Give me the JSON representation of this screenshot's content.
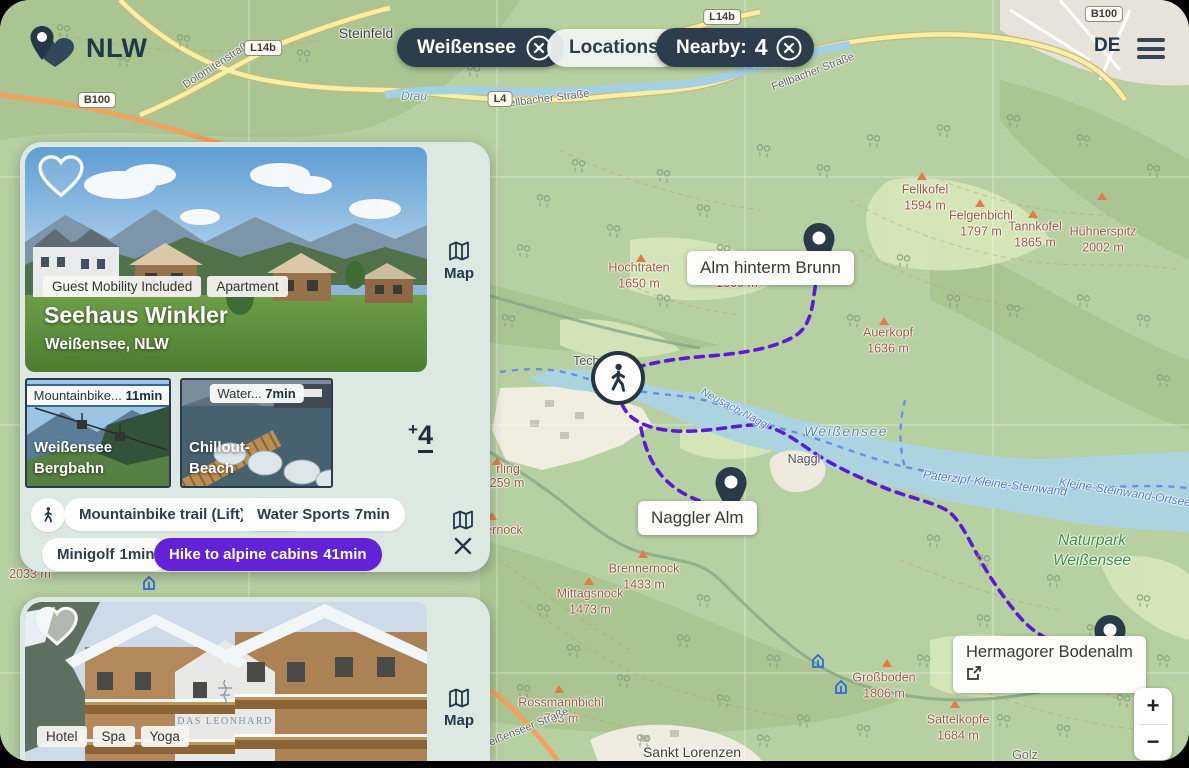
{
  "header": {
    "logo": "NLW",
    "filter_chip": "Weißensee",
    "locations": "Locations",
    "nearby_label": "Nearby:",
    "nearby_count": "4",
    "language": "DE"
  },
  "card1": {
    "tags": [
      "Guest Mobility Included",
      "Apartment"
    ],
    "title": "Seehaus Winkler",
    "subtitle": "Weißensee, NLW",
    "map_button": "Map",
    "thumbs": [
      {
        "label": "Mountainbike...",
        "time": "11min",
        "name1": "Weißensee",
        "name2": "Bergbahn"
      },
      {
        "label": "Water...",
        "time": "7min",
        "name1": "Chillout-",
        "name2": "Beach"
      }
    ],
    "more_plus": "+",
    "more_count": "4",
    "activities": [
      {
        "label": "Mountainbike trail (Lift)",
        "time": "11min"
      },
      {
        "label": "Water Sports",
        "time": "7min"
      },
      {
        "label": "Minigolf",
        "time": "1min"
      },
      {
        "label": "Hike to alpine cabins",
        "time": "41min"
      }
    ]
  },
  "card2": {
    "tags": [
      "Hotel",
      "Spa",
      "Yoga"
    ],
    "map_button": "Map",
    "building_sign": "DAS LEONHARD"
  },
  "map": {
    "pois": [
      {
        "label": "Alm hinterm Brunn"
      },
      {
        "label": "Naggler Alm"
      },
      {
        "label": "Hermagorer Bodenalm"
      }
    ],
    "zoom_in": "+",
    "zoom_out": "−",
    "towns": [
      "Steinfeld",
      "Fellbach",
      "Techendorf",
      "Naggl",
      "Sankt Lorenzen",
      "Golz"
    ],
    "peaks": [
      {
        "name": "Fellkofel",
        "ele": "1594 m"
      },
      {
        "name": "Felgenbichl",
        "ele": "1797 m"
      },
      {
        "name": "Tannkofel",
        "ele": "1865 m"
      },
      {
        "name": "Hühnerspitz",
        "ele": "2002 m"
      },
      {
        "name": "Hochtraten",
        "ele": "1650 m"
      },
      {
        "name": "Auerkopf",
        "ele": "1636 m"
      },
      {
        "name": "Brennernock",
        "ele": "1433 m"
      },
      {
        "name": "Mittagsnock",
        "ele": "1473 m"
      },
      {
        "name": "Großboden",
        "ele": "1806 m"
      },
      {
        "name": "Sattelkopfe",
        "ele": "1684 m"
      },
      {
        "name": "Rossmannbichl",
        "ele": "763 m"
      }
    ],
    "partial_labels": [
      "1660 m",
      "2033 m",
      "rling",
      "259 m",
      "ernock"
    ],
    "water": {
      "river": "Drau",
      "lake": "Weißensee",
      "ferry_mid": "Neusach-Naggl",
      "ferry_east1": "Paterzipf-Kleine-Steinwand",
      "ferry_east2": "Kleine-Steinwand-Ortsee"
    },
    "park": {
      "line1": "Naturpark",
      "line2": "Weißensee"
    },
    "streets": [
      "Dolomitenstraße",
      "Fellbacher Straße",
      "Fellbacher Straße",
      "Weißenseer Straße"
    ],
    "badges": [
      "L14b",
      "L14b",
      "B100",
      "B100",
      "L4"
    ]
  },
  "colors": {
    "navy": "#2e3d4c",
    "accent_purple": "#6322d6",
    "route_purple": "#5a1bd6",
    "panel_bg": "#dce8e2",
    "water": "#abd3e0"
  }
}
